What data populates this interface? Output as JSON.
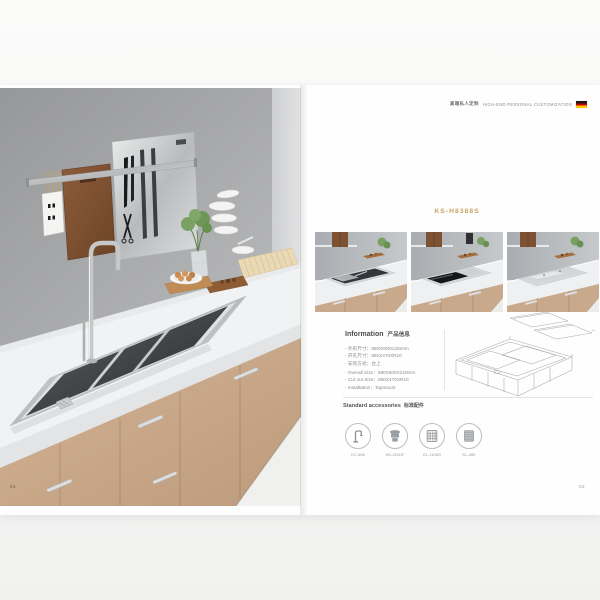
{
  "left_page": {
    "page_number": "01",
    "photo": "kitchen-scene-with-wall-rack-cutting-board-knives-faucet-double-sink-wood-cabinets"
  },
  "right_page": {
    "header": {
      "zh": "高端私人定制",
      "en": "HIGH-END PERSONAL CUSTOMIZATION",
      "flag_icon": "germany-flag-icon"
    },
    "model": "KS-H8388S",
    "gallery": [
      {
        "name": "sink-open-with-accessories"
      },
      {
        "name": "sink-half-covered-black-glass"
      },
      {
        "name": "sink-fully-covered-stainless"
      }
    ],
    "info": {
      "heading_en": "Information",
      "heading_zh": "产品信息",
      "specs_zh": [
        "外形尺寸：880X500X220mm",
        "开孔尺寸：850X470XR10",
        "安装方式：台上"
      ],
      "specs_en": [
        "Overall Size：880X500X220mm",
        "Cut out Size：850X470XR10",
        "Installation：Topmount"
      ]
    },
    "technical_drawing": "isometric-sink-wireframe-with-exploded-cover-lids",
    "accessories": {
      "heading_en": "Standard accessories",
      "heading_zh": "标准配件",
      "items": [
        {
          "icon": "faucet-icon",
          "label": "KC-606"
        },
        {
          "icon": "drain-waste-icon",
          "label": "KD-211DF"
        },
        {
          "icon": "rinse-basket-icon",
          "label": "KL-J106G"
        },
        {
          "icon": "roll-mat-icon",
          "label": "KL-480"
        }
      ]
    },
    "page_number": "02"
  },
  "colors": {
    "accent_gold": "#c9a165",
    "flag_black": "#1a1a1a",
    "flag_red": "#cc0000",
    "flag_gold": "#ffcc00"
  }
}
